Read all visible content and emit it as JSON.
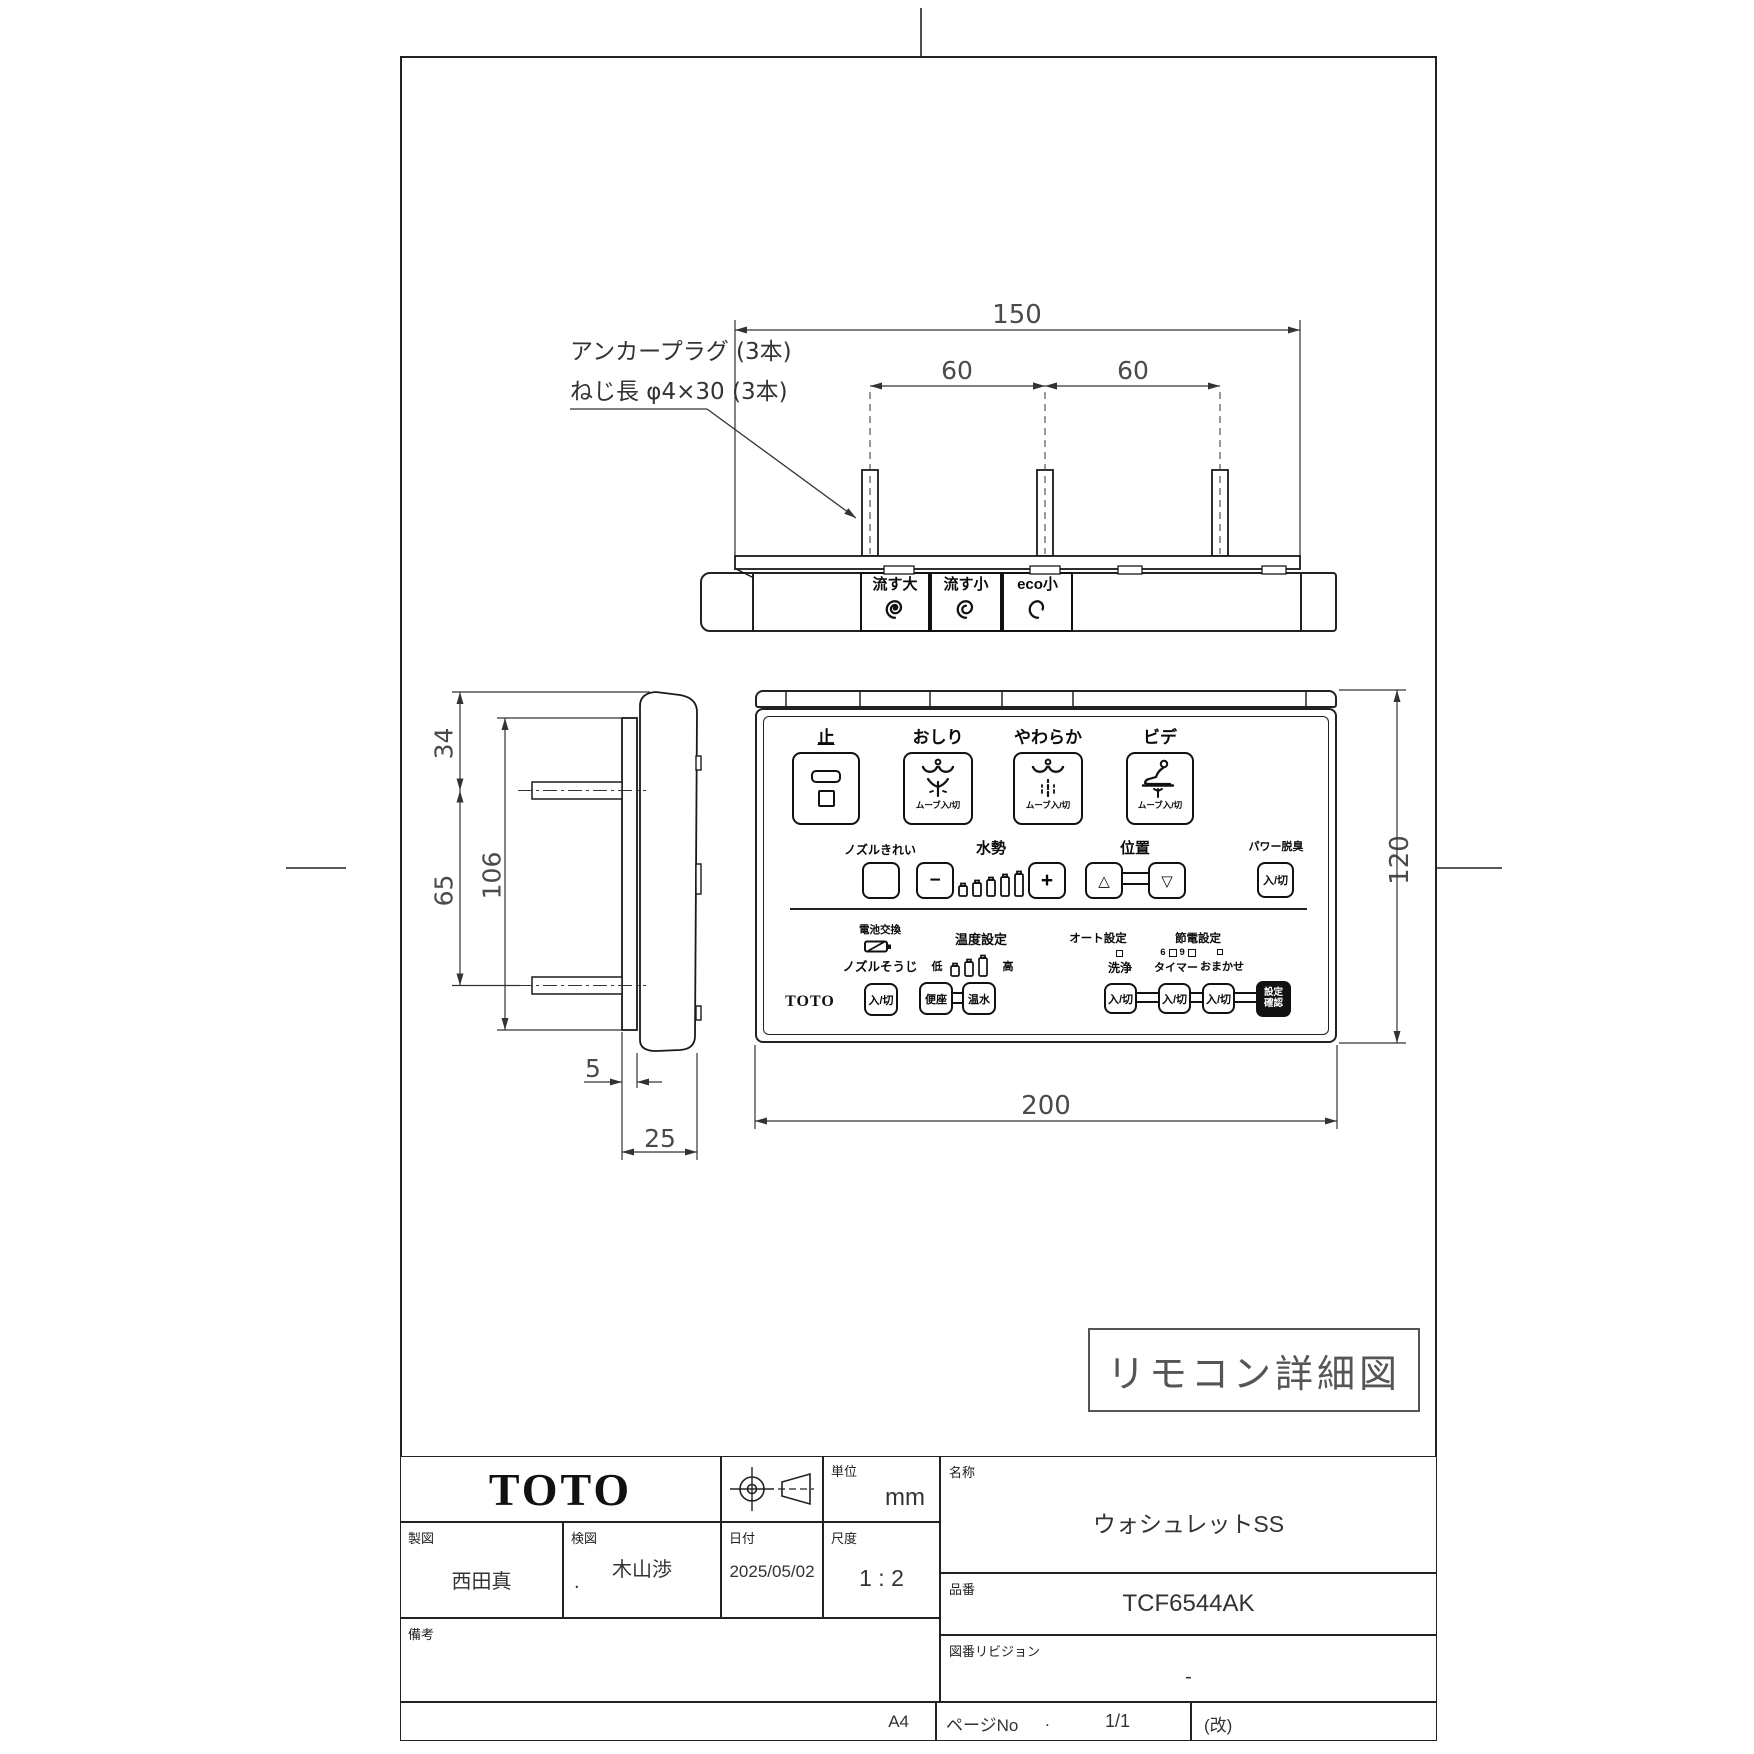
{
  "drawing": {
    "stamp": "リモコン詳細図",
    "paper_size": "A4"
  },
  "top_view": {
    "note_line1": "アンカープラグ (3本)",
    "note_line2": "ねじ長 φ4×30 (3本)",
    "dim_150": "150",
    "dim_60_left": "60",
    "dim_60_right": "60",
    "flush_large": "流す大",
    "flush_small": "流す小",
    "flush_eco": "eco小"
  },
  "side_view": {
    "dim_34": "34",
    "dim_65": "65",
    "dim_106": "106",
    "dim_5": "5",
    "dim_25": "25"
  },
  "remote": {
    "dim_120": "120",
    "dim_200": "200",
    "stop": "止",
    "oshiri": "おしり",
    "yawaraka": "やわらか",
    "bide": "ビデ",
    "move_onoff": "ムーブ入/切",
    "nozzle_clean": "ノズルきれい",
    "water_power": "水勢",
    "minus": "−",
    "plus": "+",
    "position": "位置",
    "tri_up": "△",
    "tri_down": "▽",
    "power_deodorizer": "パワー脱臭",
    "onoff": "入/切",
    "battery": "電池交換",
    "nozzle_wash": "ノズルそうじ",
    "temp_setting": "温度設定",
    "low": "低",
    "high": "高",
    "seat": "便座",
    "water": "温水",
    "auto_setting": "オート設定",
    "wash": "洗浄",
    "eco_setting": "節電設定",
    "six": "6",
    "nine": "9",
    "timer": "タイマー",
    "omakase": "おまかせ",
    "confirm_line1": "設定",
    "confirm_line2": "確認",
    "brand": "TOTO"
  },
  "title_block": {
    "logo": "TOTO",
    "unit_label": "単位",
    "unit_value": "mm",
    "drafted_label": "製図",
    "drafted_value": "西田真",
    "checked_label": "検図",
    "checked_dot": ".",
    "checked_value": "木山渉",
    "date_label": "日付",
    "date_value": "2025/05/02",
    "scale_label": "尺度",
    "scale_value": "1 : 2",
    "notes_label": "備考",
    "name_label": "名称",
    "name_value": "ウォシュレットSS",
    "part_label": "品番",
    "part_value": "TCF6544AK",
    "rev_label": "図番リビジョン",
    "rev_value": "-",
    "page_label": "ページNo",
    "page_dot": ".",
    "page_value": "1/1",
    "rev_mark": "(改)"
  }
}
